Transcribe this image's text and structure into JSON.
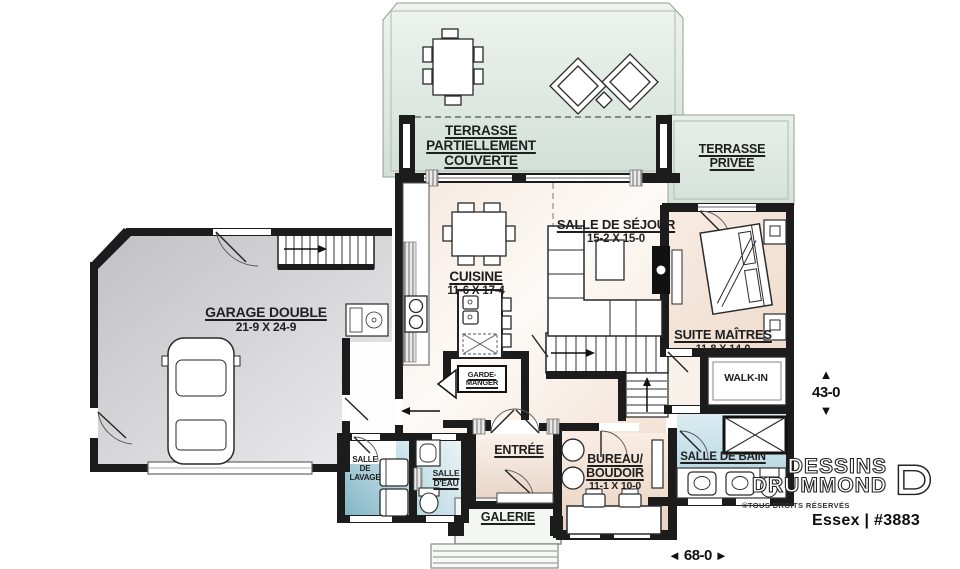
{
  "rooms": {
    "terrasse_couverte": {
      "name": "TERRASSE\nPARTIELLEMENT\nCOUVERTE"
    },
    "terrasse_privee": {
      "name": "TERRASSE\nPRIVÉE"
    },
    "salle_de_sejour": {
      "name": "SALLE DE SÉJOUR",
      "dims": "15-2 X 15-0"
    },
    "cuisine": {
      "name": "CUISINE",
      "dims": "11-6 X 17-4"
    },
    "garage": {
      "name": "GARAGE DOUBLE",
      "dims": "21-9 X 24-9"
    },
    "suite_maitres": {
      "name": "SUITE MAÎTRES",
      "dims": "11-8 X 14-0"
    },
    "walk_in": {
      "name": "WALK-IN"
    },
    "garde_manger": {
      "name": "GARDE-\nMANGER"
    },
    "salle_de_lavage": {
      "name": "SALLE\nDE\nLAVAGE"
    },
    "salle_d_eau": {
      "name": "SALLE\nD'EAU"
    },
    "entree": {
      "name": "ENTRÉE"
    },
    "bureau_boudoir": {
      "name": "BUREAU/\nBOUDOIR",
      "dims": "11-1 X 10-0"
    },
    "salle_de_bain": {
      "name": "SALLE DE BAIN"
    },
    "galerie": {
      "name": "GALERIE"
    }
  },
  "dimensions": {
    "height_label": "43-0",
    "width_label": "68-0"
  },
  "icons": {
    "arrow_up": "▲",
    "arrow_down": "▼",
    "arrow_left": "◄",
    "arrow_right": "►"
  },
  "branding": {
    "brand_line1": "DESSINS",
    "brand_line2": "DRUMMOND",
    "copyright": "©TOUS DROITS RÉSERVÉS",
    "model_name": "Essex | #3883"
  },
  "colors": {
    "wall": "#1c1c1c",
    "terrace_green": "#d9e5db",
    "interior_warm": "#f2e1d5",
    "garage_gray": "#d2d2d4",
    "water_blue": "#9fc6d4"
  }
}
